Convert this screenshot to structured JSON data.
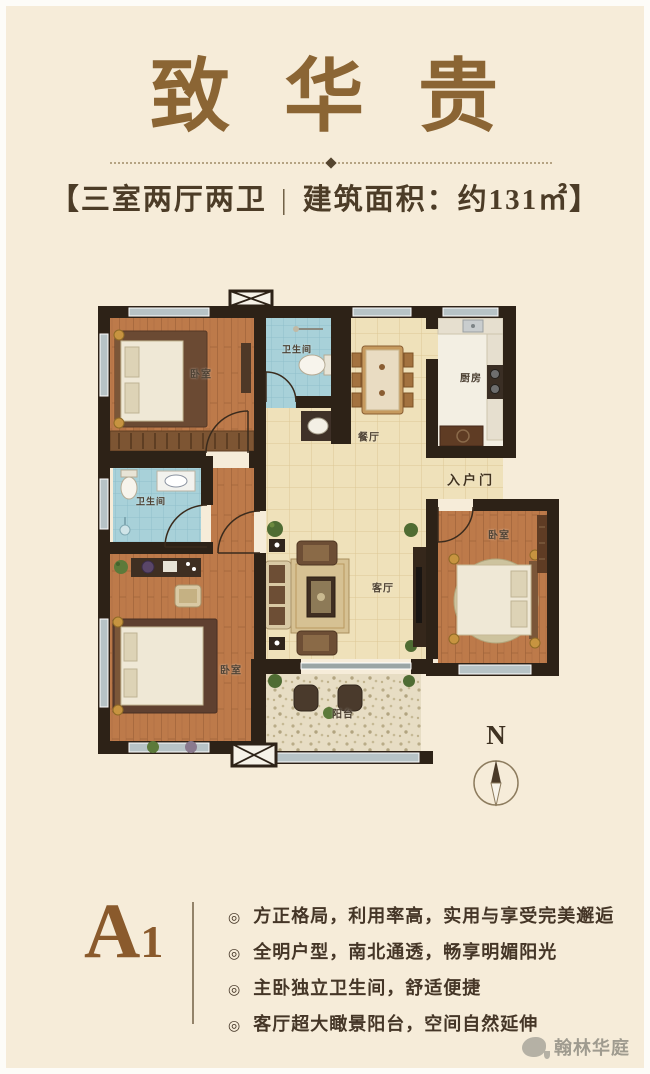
{
  "header": {
    "title": "致 华 贵",
    "subtitle": {
      "bracket_left": "【",
      "layout_type": "三室两厅两卫",
      "divider": "|",
      "area": "建筑面积：约131㎡",
      "bracket_right": "】"
    }
  },
  "floorplan": {
    "labels": {
      "bedroom_nw": "卧室",
      "bathroom_n": "卫生间",
      "dining": "餐厅",
      "kitchen": "厨房",
      "entry": "入户门",
      "bathroom_w": "卫生间",
      "bedroom_sw": "卧室",
      "living": "客厅",
      "balcony": "阳台",
      "bedroom_e": "卧室"
    },
    "compass_label": "N"
  },
  "details": {
    "plan_code_letter": "A",
    "plan_code_number": "1",
    "bullet_marker": "◎",
    "bullets": [
      "方正格局，利用率高，实用与享受完美邂逅",
      "全明户型，南北通透，畅享明媚阳光",
      "主卧独立卫生间，舒适便捷",
      "客厅超大瞰景阳台，空间自然延伸"
    ]
  },
  "watermark": {
    "brand": "翰林华庭"
  },
  "colors": {
    "background": "#f6ecd9",
    "title": "#8b6534",
    "subtitle_text": "#4c3c27",
    "wall": "#2d2217",
    "wood_floor": "#bd7a4a",
    "tile_floor": "#efe1ba",
    "bath_tile": "#a8d1d9",
    "balcony_mosaic": "#e7ddc4",
    "window": "#b7c3c6",
    "accent_code": "#8a5a2c",
    "watermark_gray": "#908d83"
  }
}
